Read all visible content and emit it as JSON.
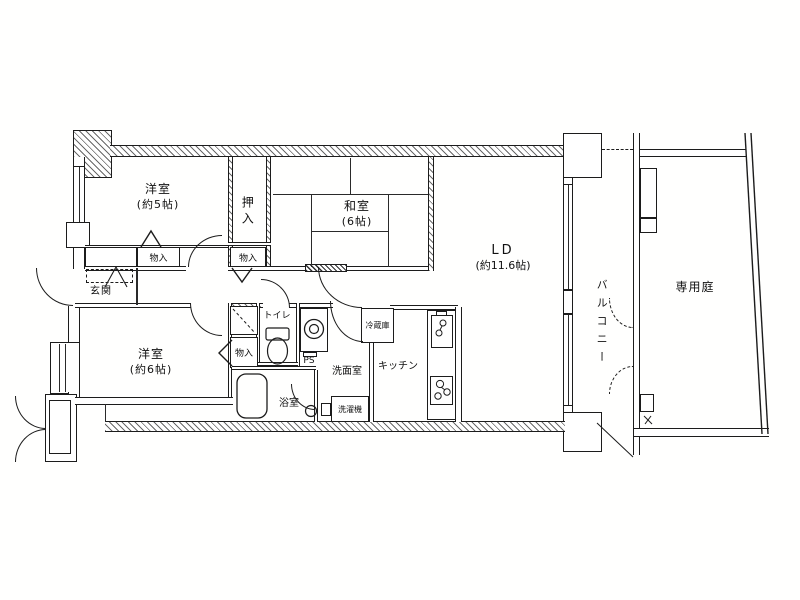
{
  "meta": {
    "kind": "japanese-apartment-floor-plan",
    "line_color": "#1c1c1c",
    "bg_color": "#ffffff"
  },
  "labels": {
    "western5_name": "洋室",
    "western5_size": "(約5帖)",
    "oshiire": "押入",
    "washitsu_name": "和室",
    "washitsu_size": "(6帖)",
    "ld_name": "LD",
    "ld_size": "(約11.6帖)",
    "balcony": "バルコニー",
    "garden": "専用庭",
    "genkan": "玄関",
    "western6_name": "洋室",
    "western6_size": "(約6帖)",
    "toilet": "トイレ",
    "washroom": "洗面室",
    "bath": "浴室",
    "kitchen": "キッチン",
    "monoire1": "物入",
    "monoire2": "物入",
    "monoire3": "物入",
    "ps": "PS",
    "fridge": "冷蔵庫",
    "washer": "洗濯機"
  }
}
